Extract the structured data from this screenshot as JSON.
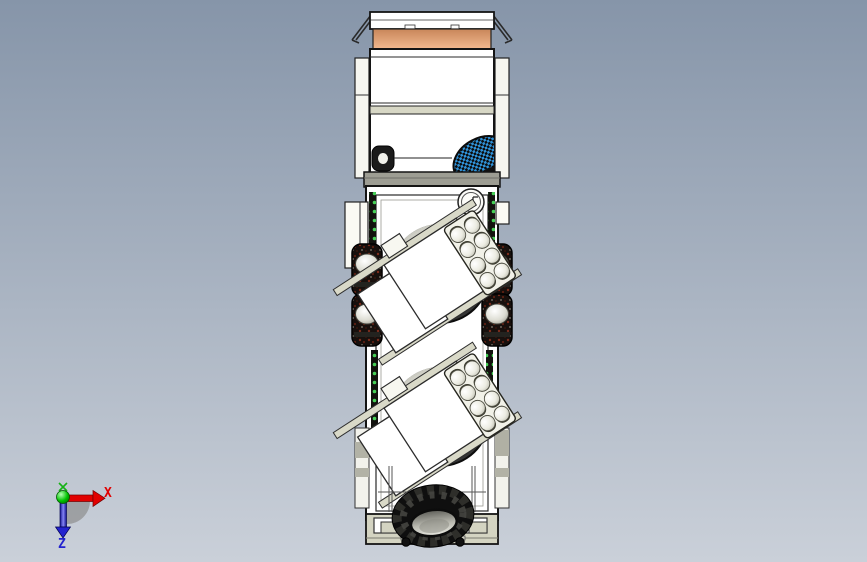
{
  "viewport": {
    "type": "3d-cad-viewport",
    "view_orientation": "top",
    "background": {
      "top": "#8695a9",
      "bottom": "#cad0d9"
    }
  },
  "triad": {
    "x_label": "X",
    "z_label": "Z",
    "x_color": "#e10000",
    "z_color": "#2323cf",
    "y_color": "#16b216",
    "origin_color": "#00c300",
    "shadow_color": "#8d8d8d"
  },
  "model": {
    "name": "truck-top-view",
    "colors": {
      "body": "#ffffff",
      "outline": "#161616",
      "windshield_top": "#c8865a",
      "windshield_bottom": "#f3b98f",
      "trim": "#d7d7c5",
      "bumper": "#d4d4c2",
      "drum": "#343434",
      "tire_base": "#17100d",
      "led": "#47d057",
      "beacon": "#2f93da"
    }
  }
}
